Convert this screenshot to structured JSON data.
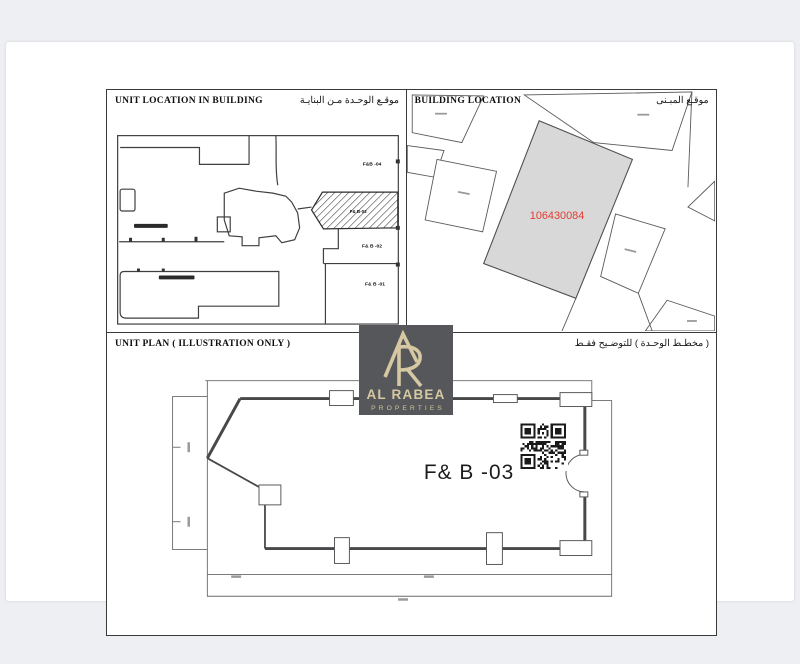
{
  "colors": {
    "background": "#edeff3",
    "paper": "#ffffff",
    "panel_border": "#3a3a3c",
    "drawing_line": "#4b4b4d",
    "parcel_fill": "#d8d8d8",
    "parcel_number_red": "#e23b32",
    "logo_background": "#56575a",
    "logo_foreground": "#d5c8a2"
  },
  "unit_location_panel": {
    "title": "UNIT LOCATION IN BUILDING",
    "title_ar": "موقـع الوحـدة مـن البنايـة",
    "unit_labels": {
      "top": "F&B -04",
      "highlighted": "F& B-03",
      "middle": "F& B -02",
      "bottom": "F& B -01"
    }
  },
  "building_location_panel": {
    "title": "BUILDING LOCATION",
    "title_ar": "موقـع المبـنى",
    "parcel_number": "106430084"
  },
  "unit_plan_panel": {
    "title": "UNIT PLAN ( ILLUSTRATION ONLY )",
    "title_ar": "( مخطـط الوحـدة ) للتوضـيح فقـط",
    "unit_label": "F& B -03"
  },
  "logo": {
    "name": "AL RABEA",
    "subtitle": "PROPERTIES"
  },
  "icons": {
    "qr_code": "qr-code-icon"
  }
}
